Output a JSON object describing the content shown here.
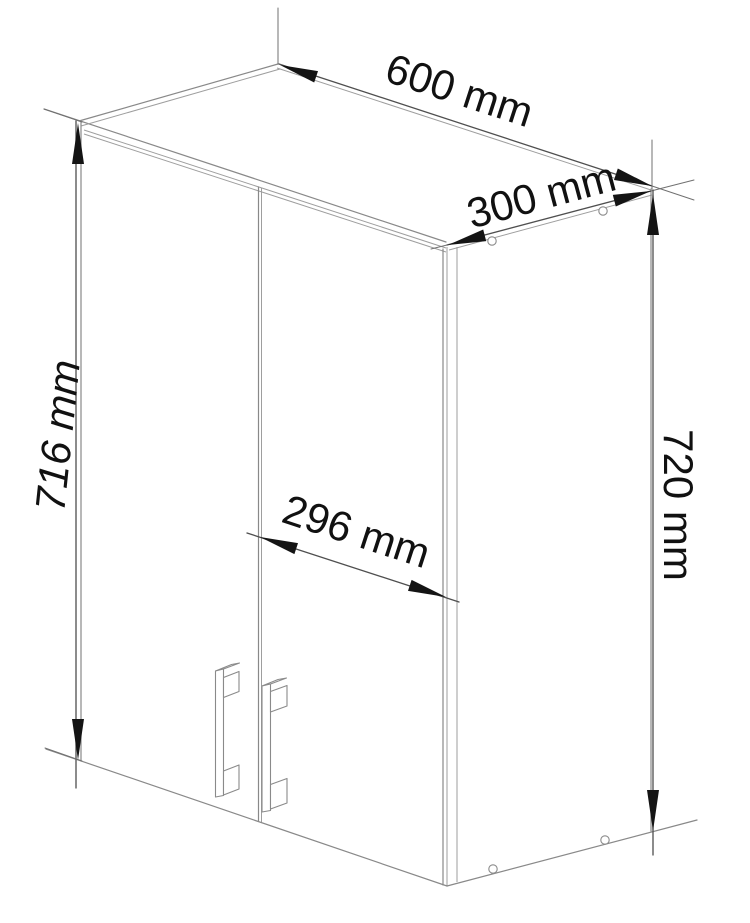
{
  "drawing": {
    "dims": {
      "width": {
        "label": "600 mm",
        "value": 600,
        "unit": "mm"
      },
      "depth": {
        "label": "300 mm",
        "value": 300,
        "unit": "mm"
      },
      "front_height": {
        "label": "716 mm",
        "value": 716,
        "unit": "mm"
      },
      "door_width": {
        "label": "296 mm",
        "value": 296,
        "unit": "mm"
      },
      "side_height": {
        "label": "720 mm",
        "value": 720,
        "unit": "mm"
      }
    },
    "colors": {
      "background": "#ffffff",
      "edge": "#898989",
      "dimension_line": "#4f4f4f",
      "text": "#111111"
    }
  }
}
